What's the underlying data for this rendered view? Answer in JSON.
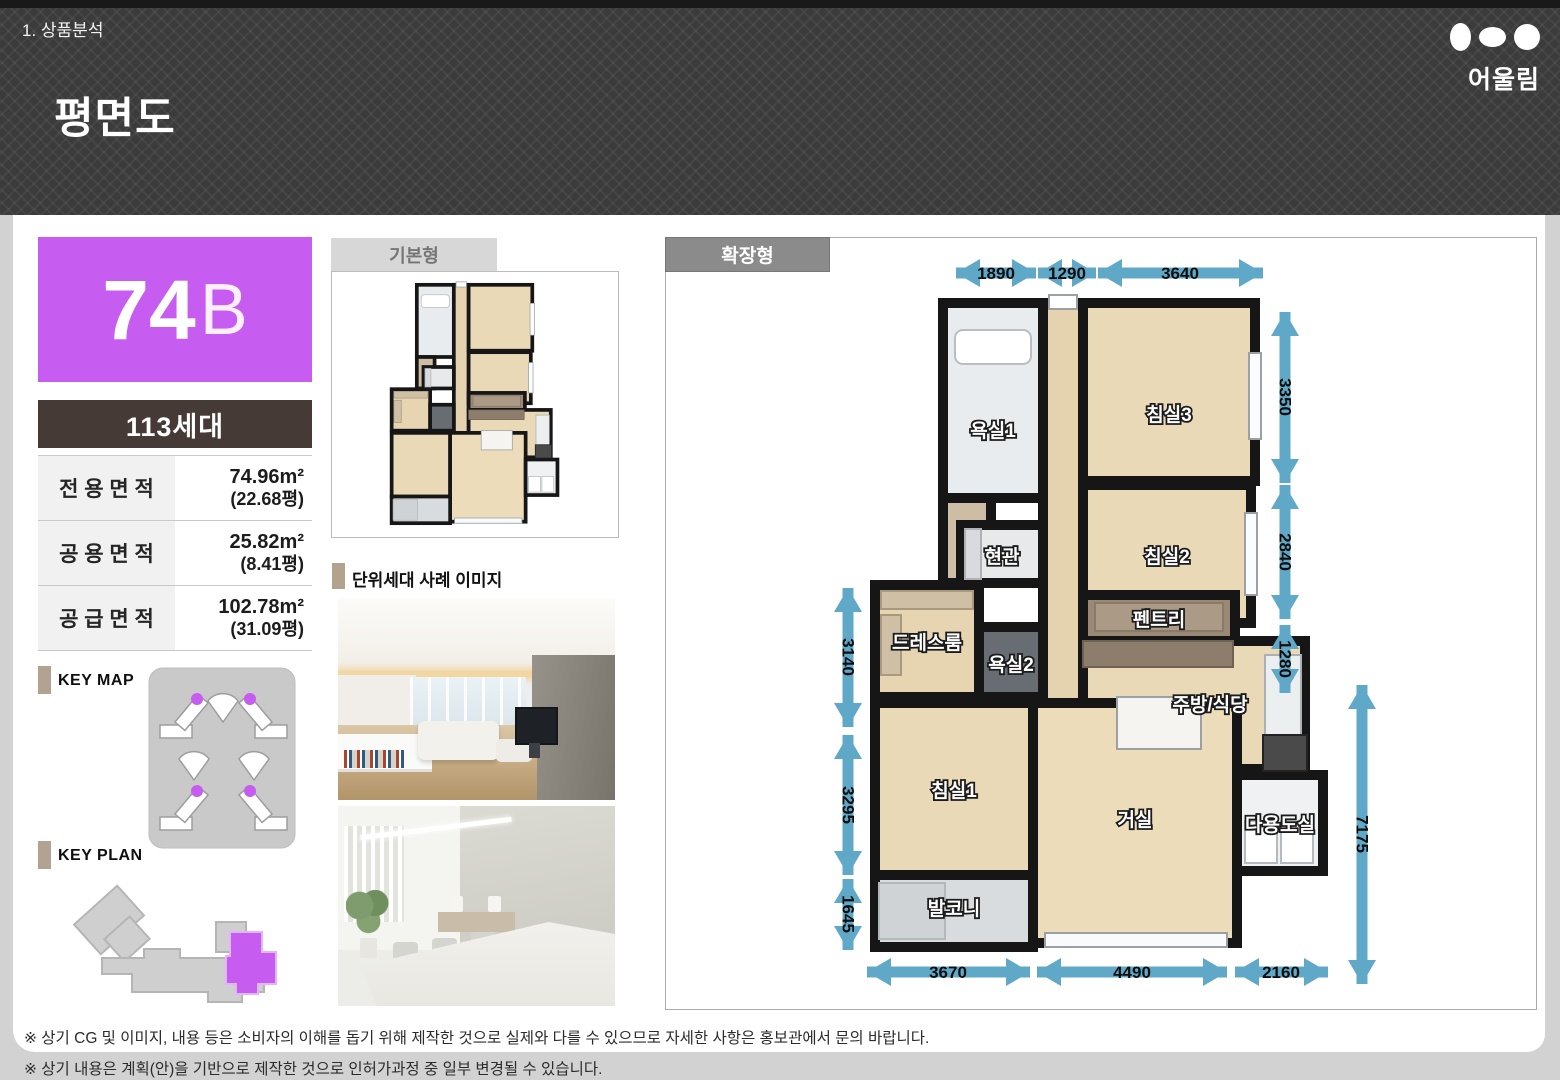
{
  "header": {
    "breadcrumb": "1. 상품분석",
    "title": "평면도",
    "brand": "어울림"
  },
  "unit": {
    "number": "74",
    "letter": "B",
    "households": "113세대"
  },
  "area_table": [
    {
      "label": "전 용 면 적",
      "area": "74.96m²",
      "pyeong": "(22.68평)"
    },
    {
      "label": "공 용 면 적",
      "area": "25.82m²",
      "pyeong": "(8.41평)"
    },
    {
      "label": "공 급 면 적",
      "area": "102.78m²",
      "pyeong": "(31.09평)"
    }
  ],
  "sections": {
    "key_map": "KEY MAP",
    "key_plan": "KEY PLAN",
    "basic_type": "기본형",
    "extended_type": "확장형",
    "sample_images": "단위세대 사례 이미지"
  },
  "plan": {
    "rooms": {
      "bath1": "욕실1",
      "bedroom3": "침실3",
      "bedroom2": "침실2",
      "entrance": "현관",
      "pantry": "펜트리",
      "dressroom": "드레스룸",
      "bath2": "욕실2",
      "kitchen": "주방/식당",
      "bedroom1": "침실1",
      "living": "거실",
      "utility": "다용도실",
      "balcony": "발코니"
    },
    "dims": {
      "top": [
        "1890",
        "1290",
        "3640"
      ],
      "right": [
        "3350",
        "2840",
        "1280"
      ],
      "right_total": "7175",
      "left": [
        "3140",
        "3295",
        "1645"
      ],
      "bottom": [
        "3670",
        "4490",
        "2160"
      ]
    }
  },
  "notes": [
    "※ 상기 CG 및 이미지, 내용 등은 소비자의 이해를 돕기 위해 제작한 것으로 실제와 다를 수 있으므로 자세한 사항은 홍보관에서 문의 바랍니다.",
    "※ 상기 내용은 계획(안)을 기반으로 제작한 것으로 인허가과정 중 일부 변경될 수 있습니다."
  ],
  "colors": {
    "accent": "#c75cf0",
    "dim_arrow": "#5fa8c8",
    "household_bg": "#463a36"
  }
}
